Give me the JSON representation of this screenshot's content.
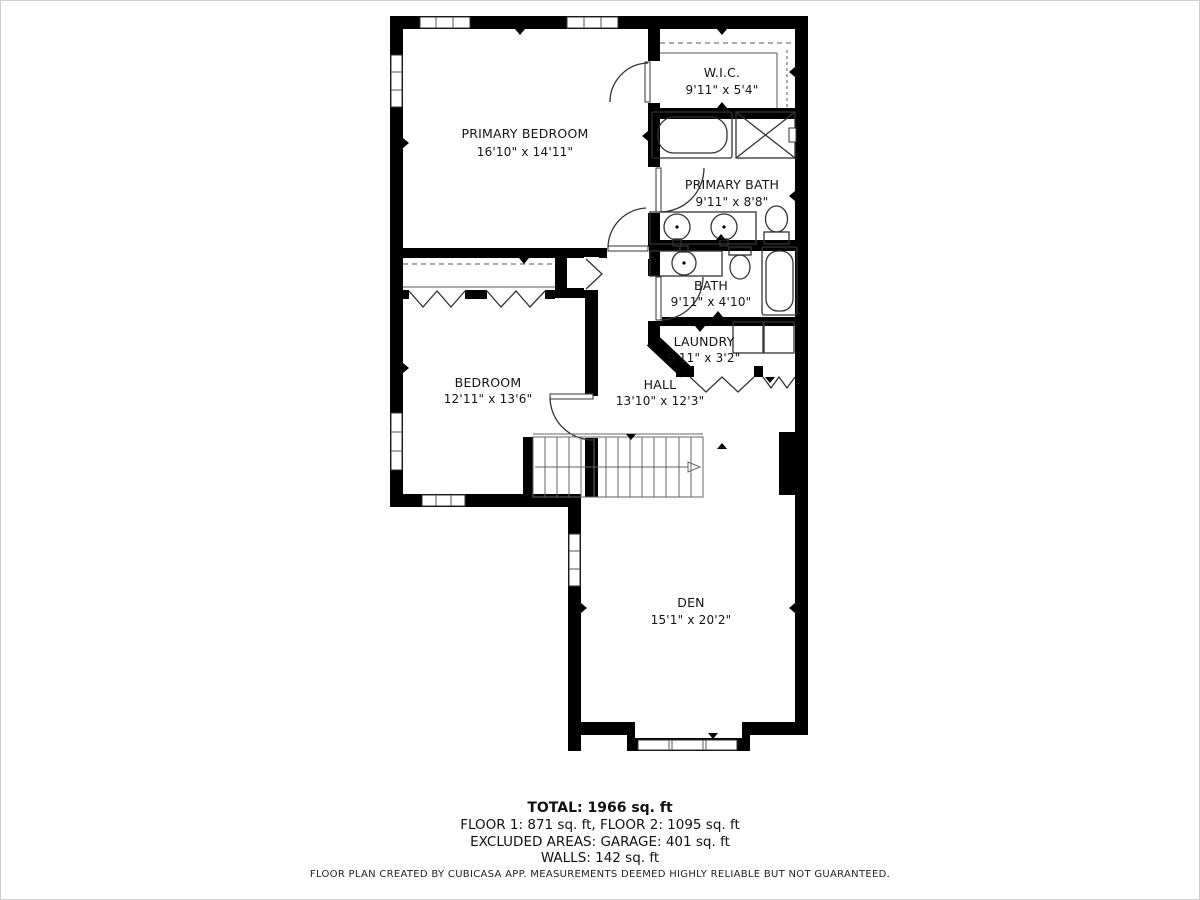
{
  "plan": {
    "rooms": [
      {
        "name": "PRIMARY BEDROOM",
        "dims": "16'10\" x 14'11\""
      },
      {
        "name": "W.I.C.",
        "dims": "9'11\" x 5'4\""
      },
      {
        "name": "PRIMARY BATH",
        "dims": "9'11\" x 8'8\""
      },
      {
        "name": "BATH",
        "dims": "9'11\" x 4'10\""
      },
      {
        "name": "LAUNDRY",
        "dims": "9'11\" x 3'2\""
      },
      {
        "name": "BEDROOM",
        "dims": "12'11\" x 13'6\""
      },
      {
        "name": "HALL",
        "dims": "13'10\" x 12'3\""
      },
      {
        "name": "DEN",
        "dims": "15'1\" x 20'2\""
      }
    ],
    "summary": {
      "total": "TOTAL: 1966 sq. ft",
      "floors": "FLOOR 1: 871 sq. ft, FLOOR 2: 1095 sq. ft",
      "excluded": "EXCLUDED AREAS: GARAGE: 401 sq. ft",
      "walls": "WALLS: 142 sq. ft"
    },
    "footer": "FLOOR PLAN CREATED BY CUBICASA APP. MEASUREMENTS DEEMED HIGHLY RELIABLE BUT NOT GUARANTEED.",
    "colors": {
      "wall": "#000000",
      "background": "#ffffff",
      "fixture": "#333333"
    }
  }
}
